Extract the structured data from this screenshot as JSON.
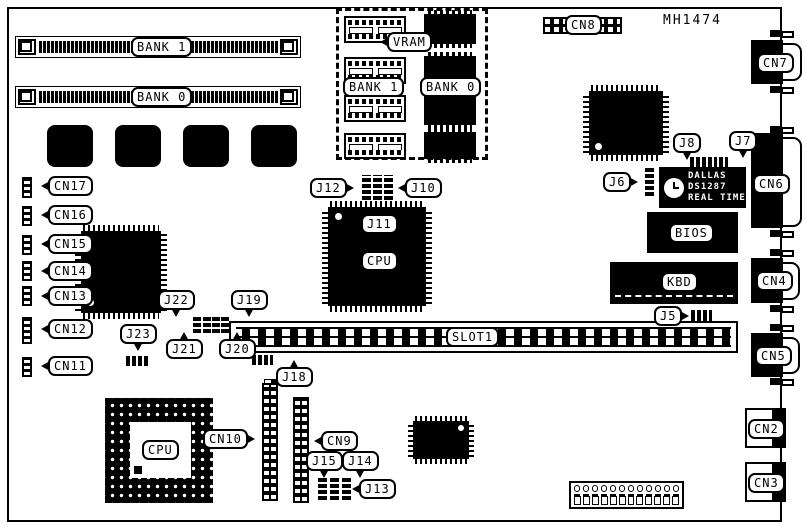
{
  "part_number": "MH1474",
  "labels": {
    "bank1": "BANK 1",
    "bank0": "BANK 0",
    "vram": "VRAM",
    "vram_bank1": "BANK 1",
    "vram_bank0": "BANK 0",
    "cn2": "CN2",
    "cn3": "CN3",
    "cn4": "CN4",
    "cn5": "CN5",
    "cn6": "CN6",
    "cn7": "CN7",
    "cn8": "CN8",
    "cn9": "CN9",
    "cn10": "CN10",
    "cn11": "CN11",
    "cn12": "CN12",
    "cn13": "CN13",
    "cn14": "CN14",
    "cn15": "CN15",
    "cn16": "CN16",
    "cn17": "CN17",
    "j5": "J5",
    "j6": "J6",
    "j7": "J7",
    "j8": "J8",
    "j10": "J10",
    "j11": "J11",
    "j12": "J12",
    "j13": "J13",
    "j14": "J14",
    "j15": "J15",
    "j18": "J18",
    "j19": "J19",
    "j20": "J20",
    "j21": "J21",
    "j22": "J22",
    "j23": "J23",
    "cpu_qfp": "CPU",
    "cpu_socket": "CPU",
    "bios": "BIOS",
    "kbd": "KBD",
    "slot1": "SLOT1"
  },
  "rtc_chip": {
    "line1": "DALLAS",
    "line2": "DS1287",
    "line3": "REAL TIME"
  },
  "colors": {
    "ink": "#000000",
    "paper": "#ffffff"
  }
}
